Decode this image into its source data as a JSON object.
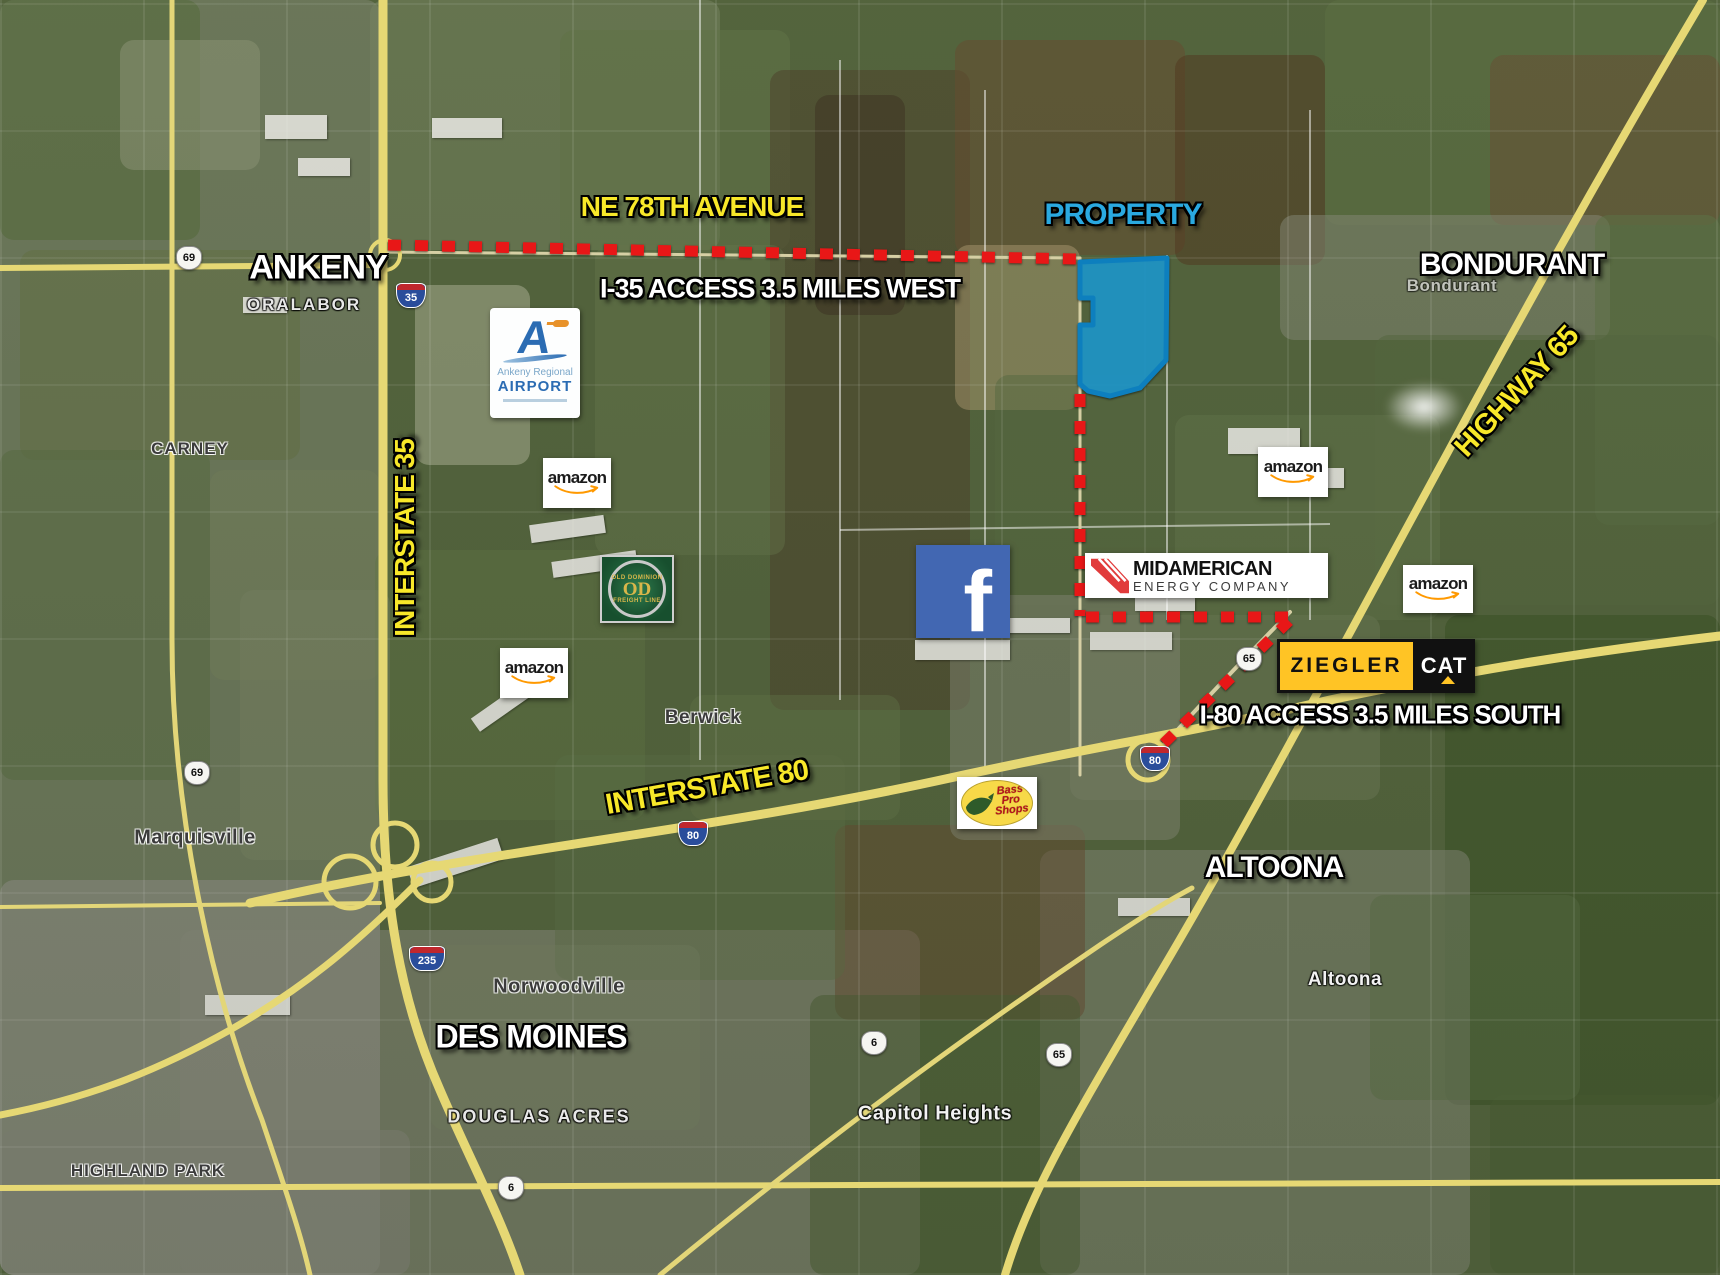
{
  "colors": {
    "property_fill": "#20a0d7",
    "property_border": "#0d7fbe",
    "dashed_route_red": "#e81717",
    "highway_label_yellow": "#f8e829",
    "city_label_white": "#ffffff",
    "property_label_cyan": "#2aa9e0"
  },
  "annotations": {
    "ne_78th": "NE 78TH AVENUE",
    "i35_access": "I-35 ACCESS 3.5 MILES WEST",
    "property": "PROPERTY",
    "i80_access": "I-80 ACCESS 3.5 MILES SOUTH",
    "interstate_35": "INTERSTATE 35",
    "interstate_80": "INTERSTATE 80",
    "highway_65": "HIGHWAY 65"
  },
  "cities": {
    "ankeny": "ANKENY",
    "bondurant": "BONDURANT",
    "altoona": "ALTOONA",
    "des_moines": "DES MOINES"
  },
  "places": {
    "oralabor": "ORALABOR",
    "carney": "CARNEY",
    "berwick": "Berwick",
    "marquisville": "Marquisville",
    "norwoodville": "Norwoodville",
    "douglas_acres": "DOUGLAS ACRES",
    "capitol_heights": "Capitol Heights",
    "highland_park": "HIGHLAND PARK",
    "altoona_small": "Altoona",
    "bondurant_small": "Bondurant"
  },
  "logos": {
    "airport": {
      "letter": "A",
      "line1": "Ankeny Regional",
      "line2": "AIRPORT"
    },
    "amazon": "amazon",
    "facebook": "f",
    "midamerican": {
      "line1": "MIDAMERICAN",
      "line2": "ENERGY COMPANY"
    },
    "ziegler": {
      "name": "ZIEGLER",
      "cat": "CAT"
    },
    "bass_pro": {
      "line1": "Bass",
      "line2": "Pro",
      "line3": "Shops"
    },
    "old_dominion": {
      "top": "OLD DOMINION",
      "center": "OD",
      "bottom": "FREIGHT LINE"
    }
  },
  "shields": [
    {
      "label": "69"
    },
    {
      "label": "35"
    },
    {
      "label": "69"
    },
    {
      "label": "235"
    },
    {
      "label": "80"
    },
    {
      "label": "80"
    },
    {
      "label": "65"
    },
    {
      "label": "6"
    },
    {
      "label": "65"
    },
    {
      "label": "6"
    }
  ]
}
